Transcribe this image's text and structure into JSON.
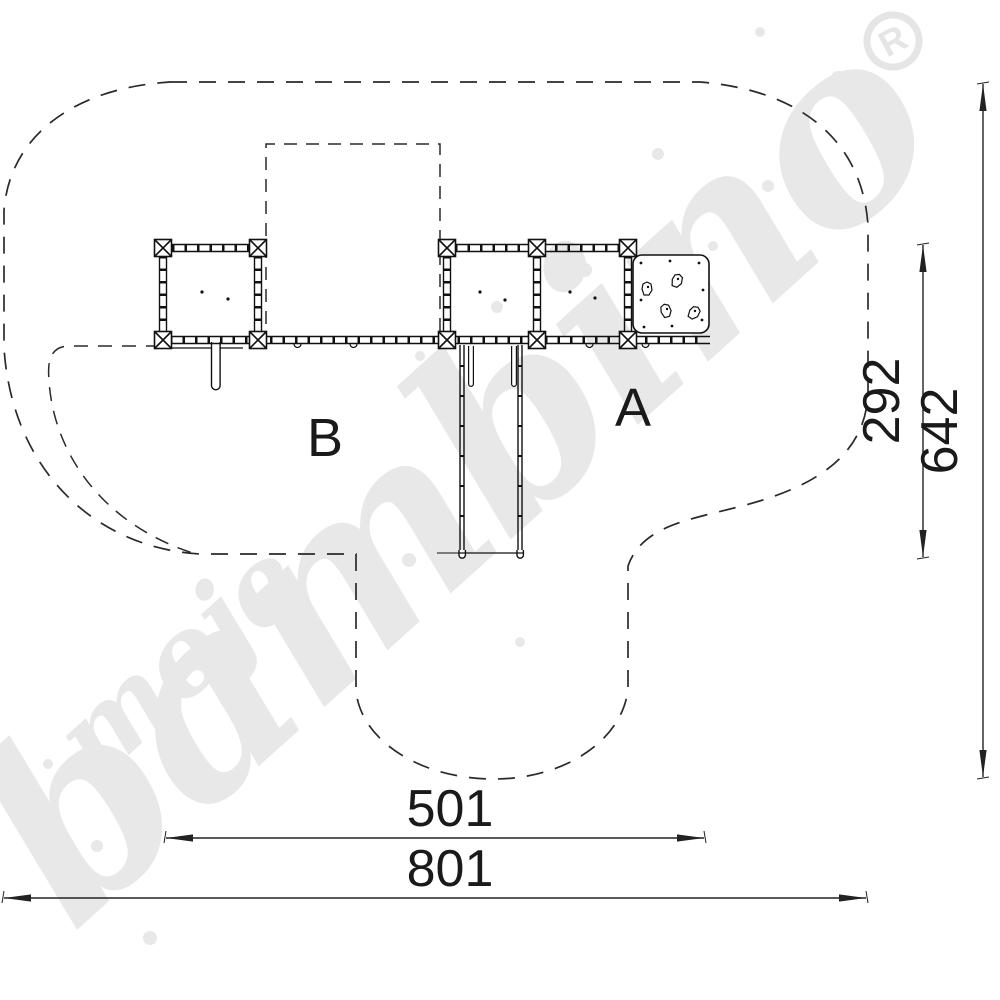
{
  "drawing": {
    "zone_labels": {
      "a": "A",
      "b": "B"
    },
    "dimensions": {
      "inner_width": {
        "value": "501"
      },
      "total_width": {
        "value": "801"
      },
      "inner_height": {
        "value": "292"
      },
      "total_height": {
        "value": "642"
      }
    }
  },
  "watermark": {
    "word_small": "moje",
    "word_large": "bambino",
    "registered": "R"
  },
  "colors": {
    "line": "#1a1a1a",
    "dashed_outline": "#2a2a2a",
    "watermark": "#e8e8e8",
    "background": "#ffffff"
  }
}
